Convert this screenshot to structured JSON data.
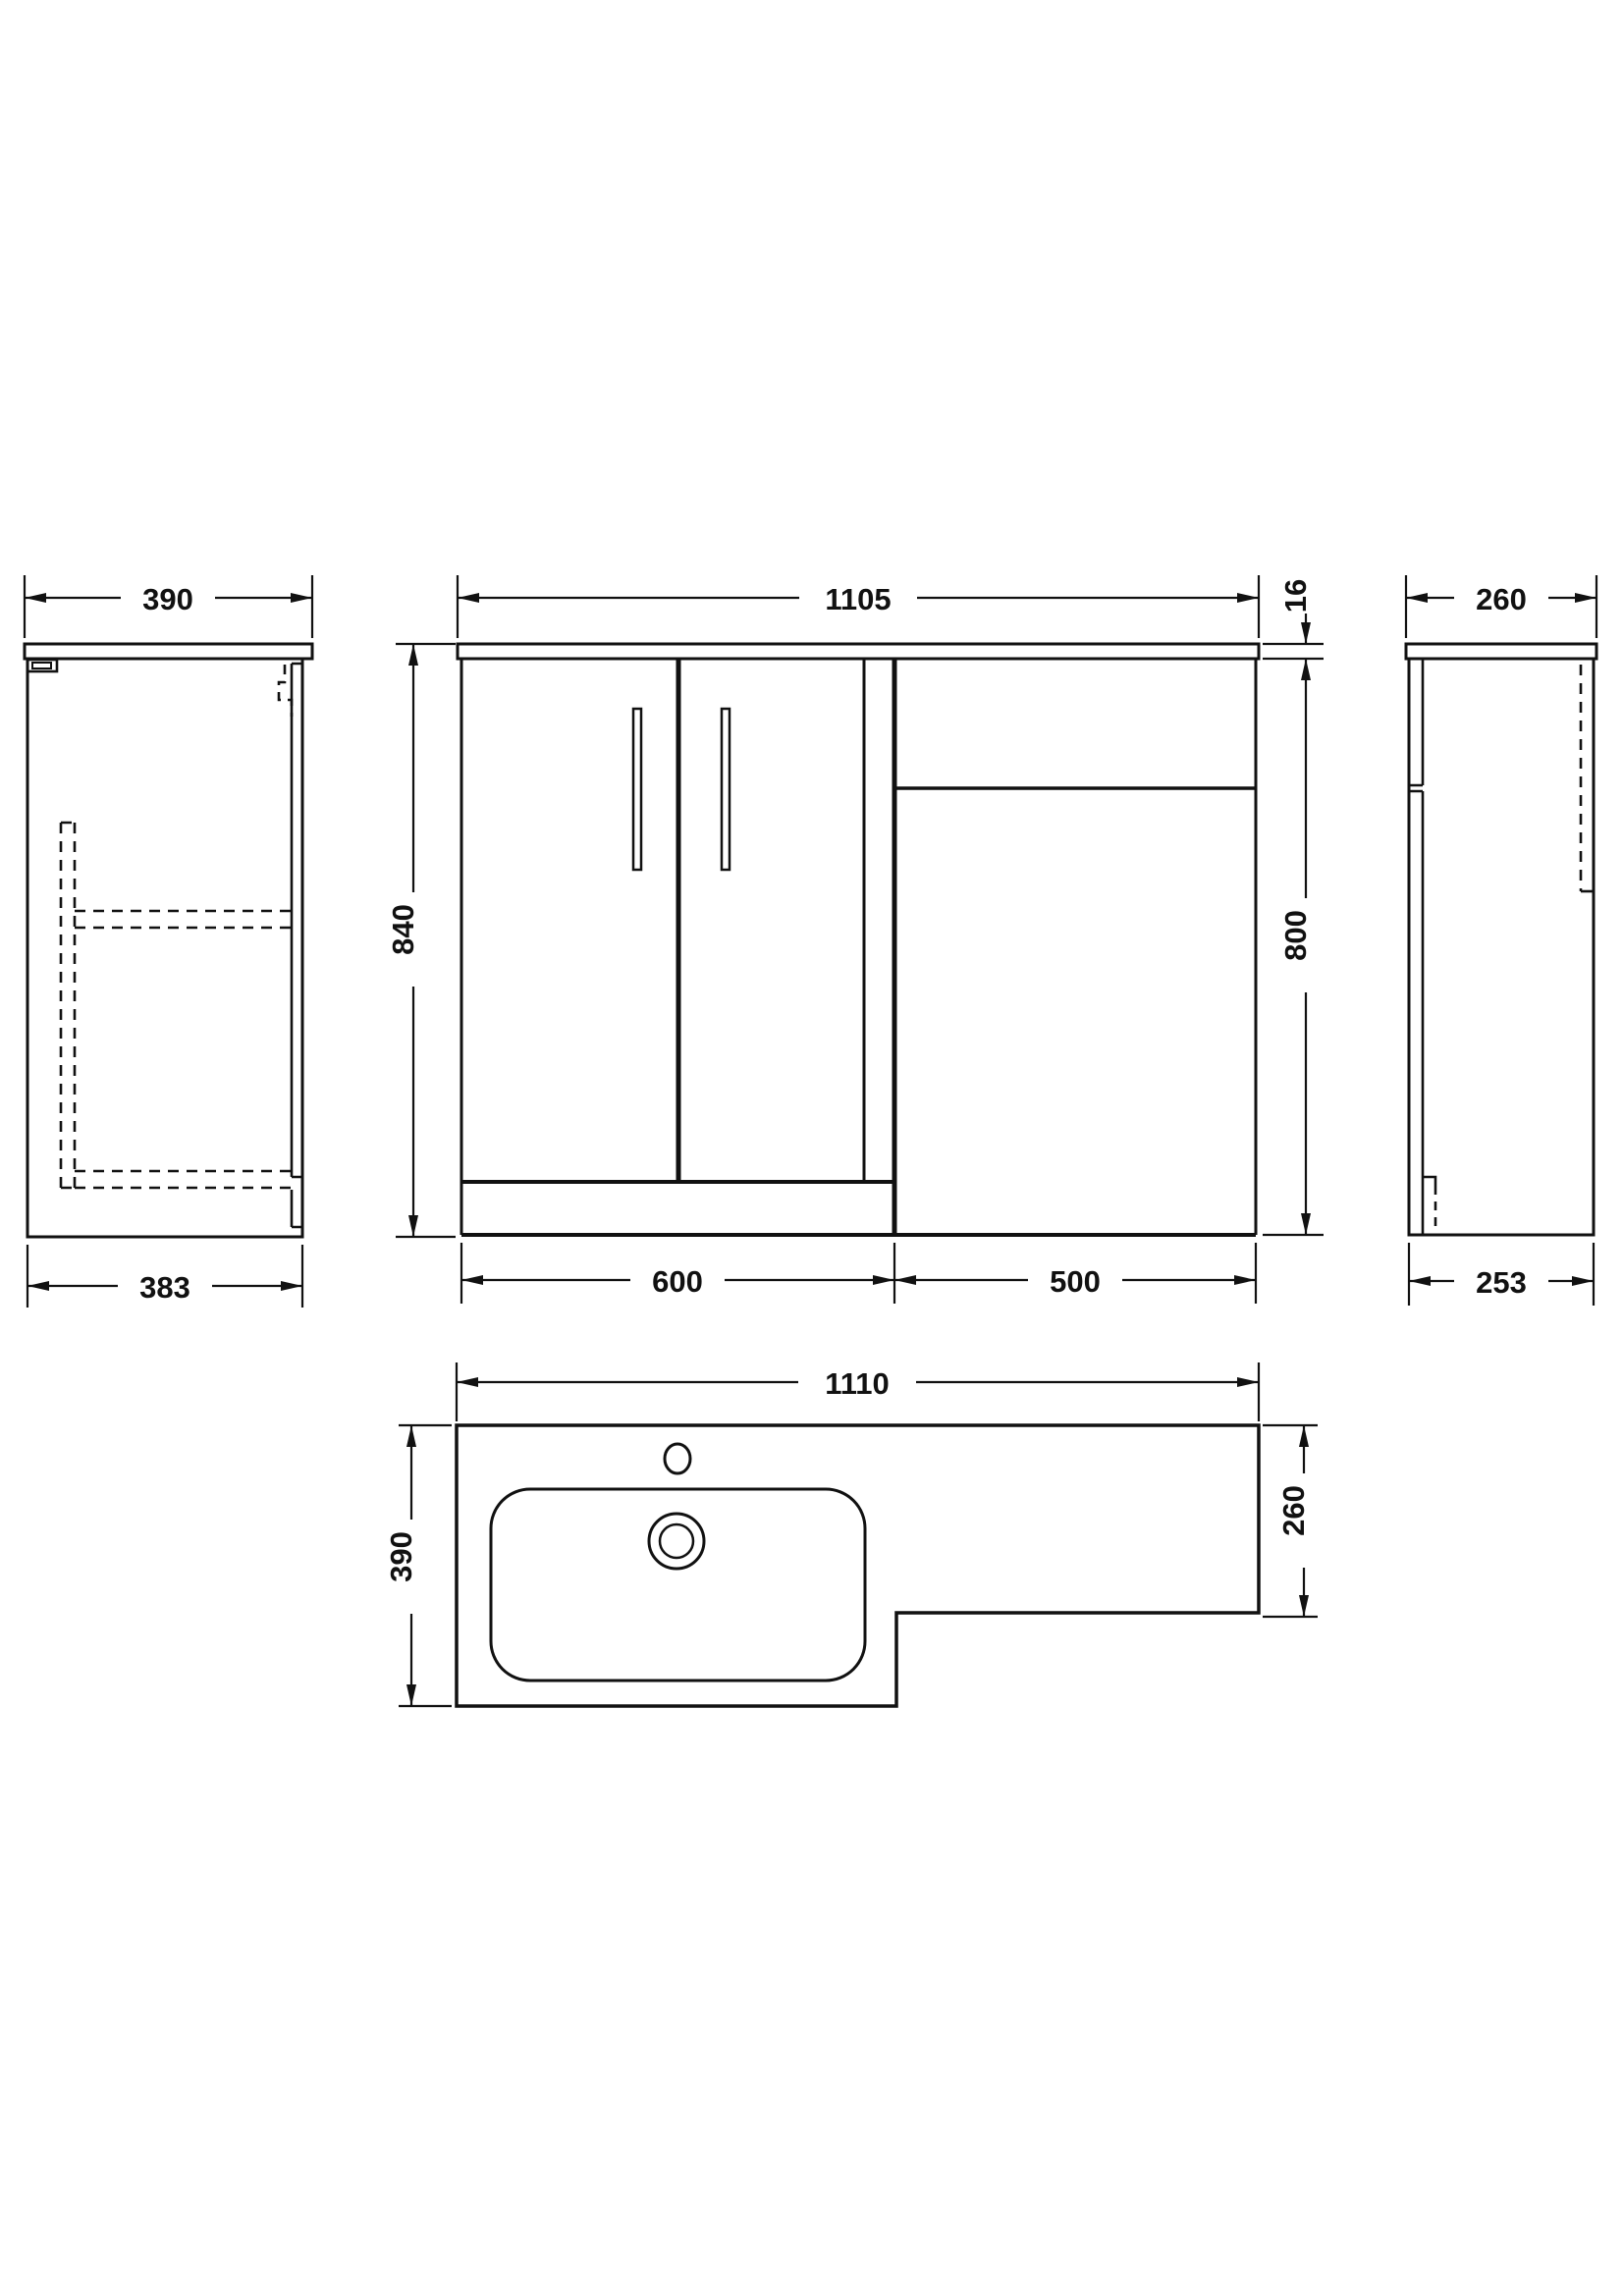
{
  "units": "mm",
  "colors": {
    "background": "#ffffff",
    "line": "#111111"
  },
  "views": {
    "left_side": {
      "dim_worktop_depth": "390",
      "dim_cabinet_depth": "383"
    },
    "front": {
      "dim_worktop_width": "1105",
      "dim_total_height": "840",
      "dim_worktop_thickness": "16",
      "dim_cabinet_height": "800",
      "dim_vanity_width": "600",
      "dim_wc_unit_width": "500"
    },
    "right_side": {
      "dim_worktop_depth": "260",
      "dim_cabinet_depth": "253"
    },
    "plan": {
      "dim_worktop_width": "1110",
      "dim_basin_end_depth": "390",
      "dim_wc_end_depth": "260"
    }
  }
}
